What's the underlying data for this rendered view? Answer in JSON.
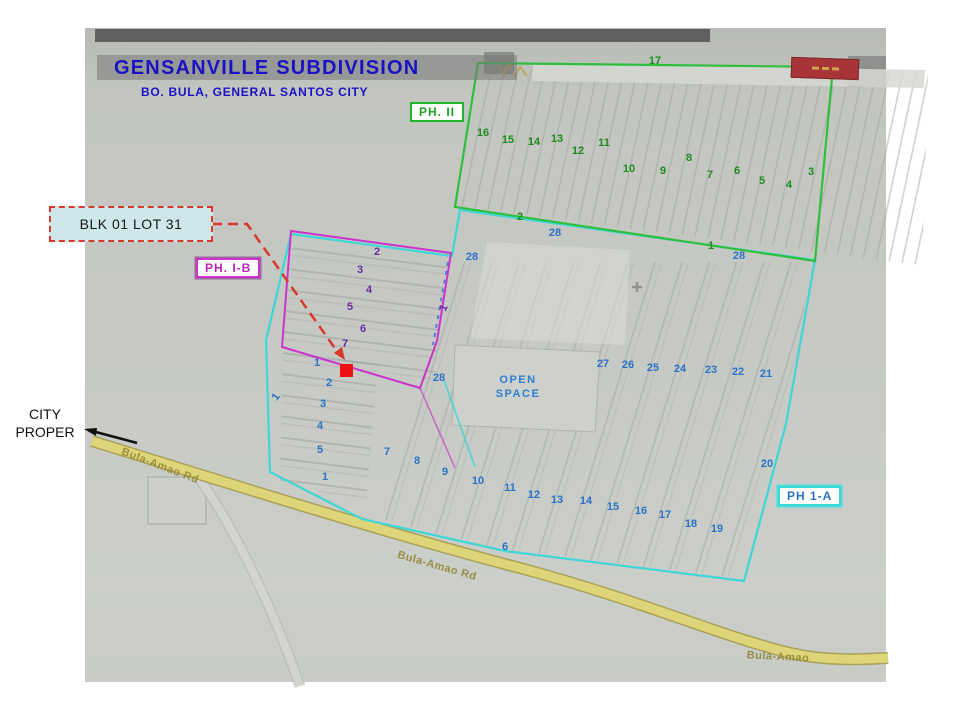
{
  "header": {
    "title": "GENSANVILLE SUBDIVISION",
    "subtitle": "BO. BULA, GENERAL SANTOS CITY"
  },
  "phase_badges": [
    {
      "id": "ph2",
      "label": "PH. II"
    },
    {
      "id": "ph1b",
      "label": "PH. I-B"
    },
    {
      "id": "ph1a",
      "label": "PH 1-A"
    }
  ],
  "callout": {
    "label": "BLK 01 LOT 31"
  },
  "city_proper": {
    "line1": "CITY",
    "line2": "PROPER"
  },
  "open_space": {
    "line1": "OPEN",
    "line2": "SPACE"
  },
  "road_labels": [
    {
      "t": "Bula-Amao Rd",
      "x": 160,
      "y": 466,
      "rot": 21
    },
    {
      "t": "Bula-Amao Rd",
      "x": 437,
      "y": 566,
      "rot": 16
    },
    {
      "t": "Bula-Amao",
      "x": 778,
      "y": 657,
      "rot": 3
    }
  ],
  "lot_labels": {
    "phase2": [
      {
        "t": "17",
        "x": 655,
        "y": 61
      },
      {
        "t": "16",
        "x": 483,
        "y": 133
      },
      {
        "t": "15",
        "x": 508,
        "y": 140
      },
      {
        "t": "14",
        "x": 534,
        "y": 142
      },
      {
        "t": "13",
        "x": 557,
        "y": 139
      },
      {
        "t": "12",
        "x": 578,
        "y": 151
      },
      {
        "t": "11",
        "x": 604,
        "y": 143
      },
      {
        "t": "10",
        "x": 629,
        "y": 169
      },
      {
        "t": "9",
        "x": 663,
        "y": 171
      },
      {
        "t": "8",
        "x": 689,
        "y": 158
      },
      {
        "t": "7",
        "x": 710,
        "y": 175
      },
      {
        "t": "6",
        "x": 737,
        "y": 171
      },
      {
        "t": "5",
        "x": 762,
        "y": 181
      },
      {
        "t": "4",
        "x": 789,
        "y": 185
      },
      {
        "t": "3",
        "x": 811,
        "y": 172
      },
      {
        "t": "2",
        "x": 520,
        "y": 217
      },
      {
        "t": "1",
        "x": 711,
        "y": 246
      }
    ],
    "phase1b": [
      {
        "t": "2",
        "x": 377,
        "y": 252
      },
      {
        "t": "3",
        "x": 360,
        "y": 270
      },
      {
        "t": "4",
        "x": 369,
        "y": 290
      },
      {
        "t": "5",
        "x": 350,
        "y": 307
      },
      {
        "t": "6",
        "x": 363,
        "y": 329
      },
      {
        "t": "7",
        "x": 345,
        "y": 344
      },
      {
        "t": "1",
        "x": 444,
        "y": 308,
        "rot": -65
      }
    ],
    "phase1a": [
      {
        "t": "28",
        "x": 472,
        "y": 257
      },
      {
        "t": "28",
        "x": 555,
        "y": 233
      },
      {
        "t": "28",
        "x": 739,
        "y": 256
      },
      {
        "t": "28",
        "x": 439,
        "y": 378
      },
      {
        "t": "1",
        "x": 276,
        "y": 397,
        "rot": -55
      },
      {
        "t": "1",
        "x": 317,
        "y": 363
      },
      {
        "t": "2",
        "x": 329,
        "y": 383
      },
      {
        "t": "3",
        "x": 323,
        "y": 404
      },
      {
        "t": "4",
        "x": 320,
        "y": 426
      },
      {
        "t": "5",
        "x": 320,
        "y": 450
      },
      {
        "t": "1",
        "x": 325,
        "y": 477
      },
      {
        "t": "7",
        "x": 387,
        "y": 452
      },
      {
        "t": "8",
        "x": 417,
        "y": 461
      },
      {
        "t": "9",
        "x": 445,
        "y": 472
      },
      {
        "t": "10",
        "x": 478,
        "y": 481
      },
      {
        "t": "11",
        "x": 510,
        "y": 488
      },
      {
        "t": "12",
        "x": 534,
        "y": 495
      },
      {
        "t": "13",
        "x": 557,
        "y": 500
      },
      {
        "t": "14",
        "x": 586,
        "y": 501
      },
      {
        "t": "15",
        "x": 613,
        "y": 507
      },
      {
        "t": "16",
        "x": 641,
        "y": 511
      },
      {
        "t": "17",
        "x": 665,
        "y": 515
      },
      {
        "t": "18",
        "x": 691,
        "y": 524
      },
      {
        "t": "19",
        "x": 717,
        "y": 529
      },
      {
        "t": "6",
        "x": 505,
        "y": 547
      },
      {
        "t": "20",
        "x": 767,
        "y": 464
      },
      {
        "t": "27",
        "x": 603,
        "y": 364
      },
      {
        "t": "26",
        "x": 628,
        "y": 365
      },
      {
        "t": "25",
        "x": 653,
        "y": 368
      },
      {
        "t": "24",
        "x": 680,
        "y": 369
      },
      {
        "t": "23",
        "x": 711,
        "y": 370
      },
      {
        "t": "22",
        "x": 738,
        "y": 372
      },
      {
        "t": "21",
        "x": 766,
        "y": 374
      }
    ]
  },
  "icons": {
    "marker": "red-square-marker",
    "callout_arrow": "red-dashed-arrow",
    "city_arrow": "left-arrow",
    "stamp": "red-stamp-badge",
    "scribble": "orange-scribble",
    "cross": "plus-mark"
  },
  "colors": {
    "title_blue": "#1a12c4",
    "phase2_green": "#1fb42c",
    "phase2_numbers": "#1f8a1f",
    "phase1b_magenta": "#cc33cc",
    "phase1b_numbers": "#6b2da0",
    "phase1a_cyan": "#3fd6d6",
    "phase1a_numbers": "#2b72c8",
    "road_yellow": "#ded57a",
    "road_text": "#8f8432",
    "callout_border_red": "#d8392b",
    "callout_bg": "#cfe7ea",
    "marker_red": "#ee1111",
    "stamp_red": "#a83438",
    "paper_gray": "#c6c9c4"
  }
}
